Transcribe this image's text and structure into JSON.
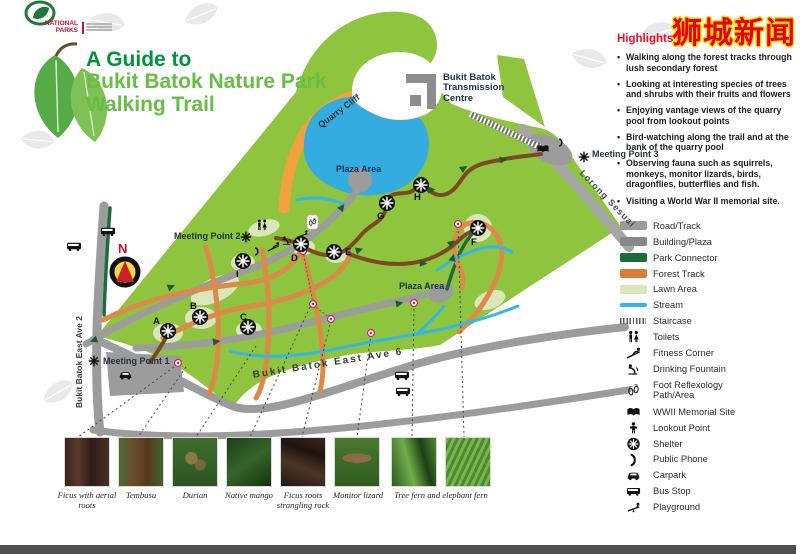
{
  "watermark": "狮城新闻",
  "logo": {
    "line1": "NATIONAL",
    "line2": "PARKS"
  },
  "title": {
    "line1": "A Guide to",
    "line2": "Bukit Batok Nature Park",
    "line3": "Walking Trail"
  },
  "highlights": {
    "heading": "Highlights",
    "items": [
      "Walking along the forest tracks through lush secondary forest",
      "Looking at interesting species of trees and shrubs with their fruits and flowers",
      "Enjoying vantage views of the quarry pool from lookout points",
      "Bird-watching along the trail and at the bank of the quarry pool",
      "Observing fauna such as squirrels, monkeys, monitor lizards, birds, dragonflies, butterflies and fish.",
      "Visiting a World War II memorial site."
    ]
  },
  "legend": {
    "items": [
      {
        "label": "Road/Track"
      },
      {
        "label": "Building/Plaza"
      },
      {
        "label": "Park Connector"
      },
      {
        "label": "Forest Track"
      },
      {
        "label": "Lawn Area"
      },
      {
        "label": "Stream"
      },
      {
        "label": "Staircase"
      },
      {
        "label": "Toilets"
      },
      {
        "label": "Fitness Corner"
      },
      {
        "label": "Drinking Fountain"
      },
      {
        "label": "Foot Reflexology Path/Area"
      },
      {
        "label": "WWII Memorial Site"
      },
      {
        "label": "Lookout Point"
      },
      {
        "label": "Shelter"
      },
      {
        "label": "Public Phone"
      },
      {
        "label": "Carpark"
      },
      {
        "label": "Bus Stop"
      },
      {
        "label": "Playground"
      }
    ]
  },
  "map": {
    "labels": {
      "transmission_1": "Bukit Batok",
      "transmission_2": "Transmission",
      "transmission_3": "Centre",
      "quarry_cliff": "Quarry Cliff",
      "plaza_pool": "Plaza Area",
      "plaza_east": "Plaza Area",
      "meeting_point_1": "Meeting Point 1",
      "meeting_point_2": "Meeting Point 2",
      "meeting_point_3": "Meeting Point 3",
      "lorong_sesuai": "Lorong Sesuai",
      "ave2": "Bukit Batok East Ave 2",
      "ave6": "Bukit Batok East Ave 6",
      "compass_n": "N"
    },
    "markers": [
      "A",
      "B",
      "C",
      "D",
      "E",
      "F",
      "G",
      "H",
      "I"
    ]
  },
  "photos": {
    "captions": [
      "Ficus with aerial roots",
      "Tembusu",
      "Durian",
      "Native mango",
      "Ficus roots strangling rock",
      "Monitor lizard",
      "Tree fern and elephant fern"
    ]
  },
  "colors": {
    "park_green": "#8EC43E",
    "pool_blue": "#35ACDF",
    "cliff_orange": "#F1A23E",
    "forest_track": "#DB7C3B",
    "park_connector": "#1D6B3C",
    "lawn": "#DBE6BB",
    "stream": "#2FB5E8",
    "road": "#9B9B9B",
    "building": "#8A8A8A",
    "trail_brown": "#7C4A22",
    "highlight_red": "#E8112D",
    "title_green_dark": "#00923F",
    "title_green_light": "#68BD45"
  }
}
